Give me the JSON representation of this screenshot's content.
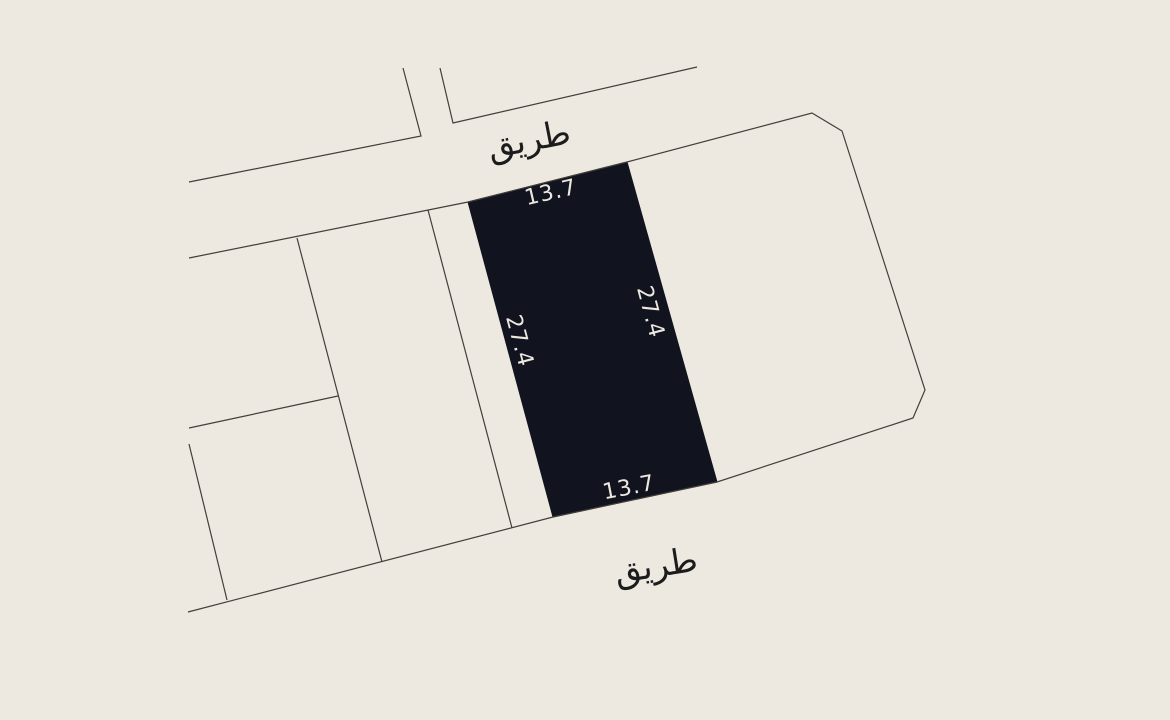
{
  "map": {
    "background_color": "#EDE9E1",
    "line_color": "#423E39",
    "parcel_fill_color": "#11141F",
    "dimension_text_color": "#ECE8E0",
    "road_text_color": "#1C1C1C"
  },
  "labels": {
    "road_top": "طريق",
    "road_bottom": "طريق"
  },
  "dimensions": {
    "top": "13.7",
    "bottom": "13.7",
    "left": "27.4",
    "right": "27.4"
  },
  "geometry": {
    "road_top_edge_west": "189,182 421,136 403,68",
    "road_top_edge_east": "440,68 453,123 697,67",
    "block_outline": "189,258 468,202 627,162 812,113 842,131 925,390 913,418 717,482 553,517 188,612",
    "parcel_divider_left": "297,238 382,562",
    "parcel_divider_right": "428,210 512,528",
    "parcel_divider_cross": "189,428 338,396",
    "lower_left_parcel_edge": "189,444 227,600",
    "highlighted_parcel": "468,202 627,162 717,482 553,517"
  }
}
